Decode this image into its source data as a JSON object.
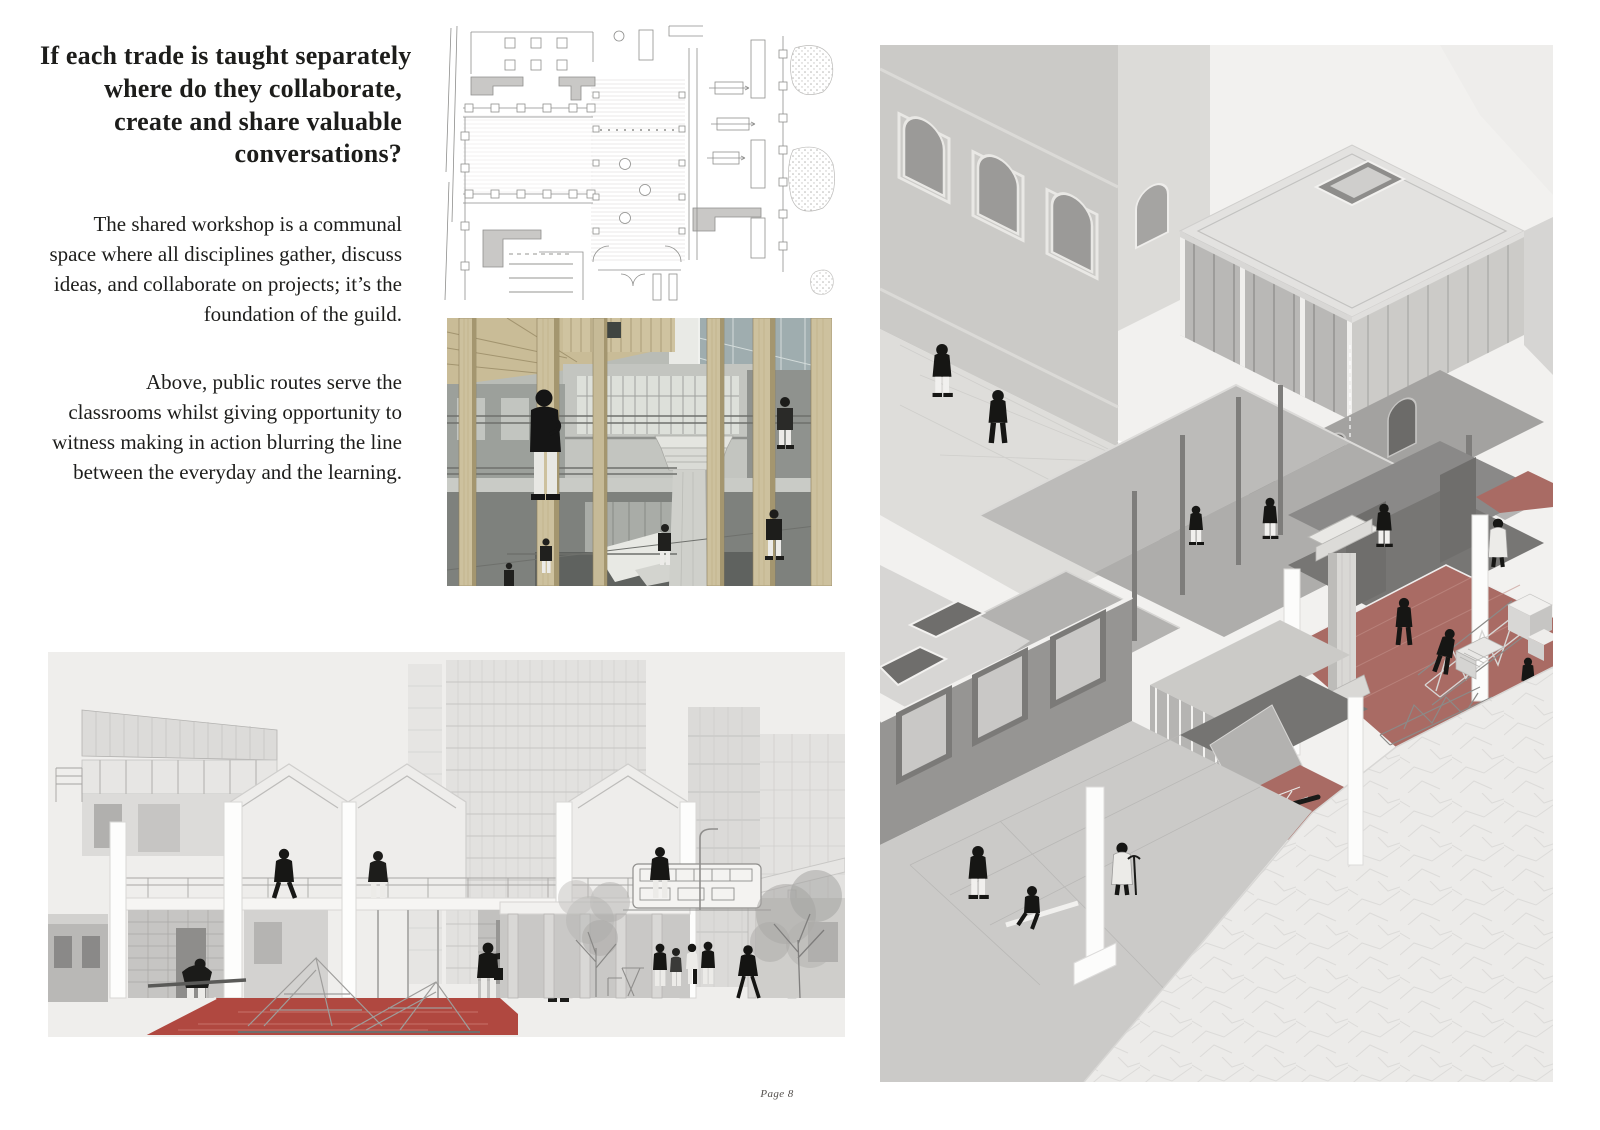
{
  "page": {
    "number_label": "Page 8",
    "background": "#ffffff"
  },
  "text_column": {
    "heading_lines": [
      "If each trade is taught separately",
      "where do they collaborate,",
      "create and share valuable",
      "conversations?"
    ],
    "paragraph_1_lines": [
      "The shared workshop is a communal",
      "space where all disciplines gather, discuss",
      "ideas, and collaborate on projects; it’s the",
      "foundation of the guild."
    ],
    "paragraph_2_lines": [
      "Above, public routes serve the",
      "classrooms whilst giving opportunity to",
      "witness making in action blurring the line",
      "between the everyday and the learning."
    ]
  },
  "figures": {
    "floor_plan": {
      "alt": "Line-drawn ground floor plan with courtyard columns, colonnades and planting"
    },
    "workshop_interior": {
      "alt": "Interior view of shared workshop atrium with timber columns and a classical stone column"
    },
    "street_section": {
      "alt": "Street section through the guild with red workshop floor, towers, bus, trees and people"
    },
    "isometric_cutaway": {
      "alt": "Isometric cutaway of the guild showing canopies, terraces and red workshop floors with makers"
    }
  },
  "palette": {
    "page_bg": "#ffffff",
    "ink": "#1d1d1b",
    "drawing_line": "#8a8a88",
    "section_panel": "#efeeec",
    "section_red_floor": "#b04840",
    "iso_red_floor": "#a96b64",
    "wood_tan": "#cdc19e",
    "mid_gray": "#b7b6b4",
    "light_gray": "#dcdbd8",
    "dark_gray": "#6f6e6c"
  }
}
